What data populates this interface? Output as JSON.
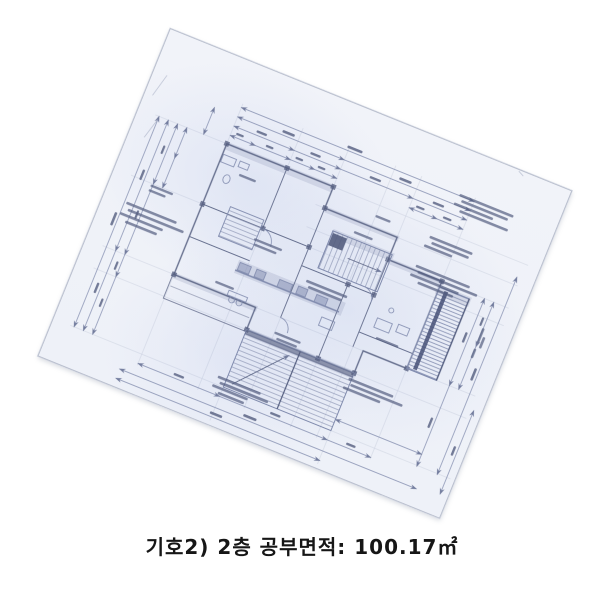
{
  "caption": {
    "full_text": "기호2) 2층 공부면적: 100.17㎡",
    "symbol": "기호2)",
    "floor": "2층",
    "area_label": "공부면적",
    "area_value": "100.17㎡"
  },
  "colors": {
    "page_background": "#ffffff",
    "paper": "#f1f3f9",
    "paper_shade": "#dde3f2",
    "ink": "#7b86aa",
    "ink_dark": "#4c5679",
    "caption_text": "#161616"
  }
}
